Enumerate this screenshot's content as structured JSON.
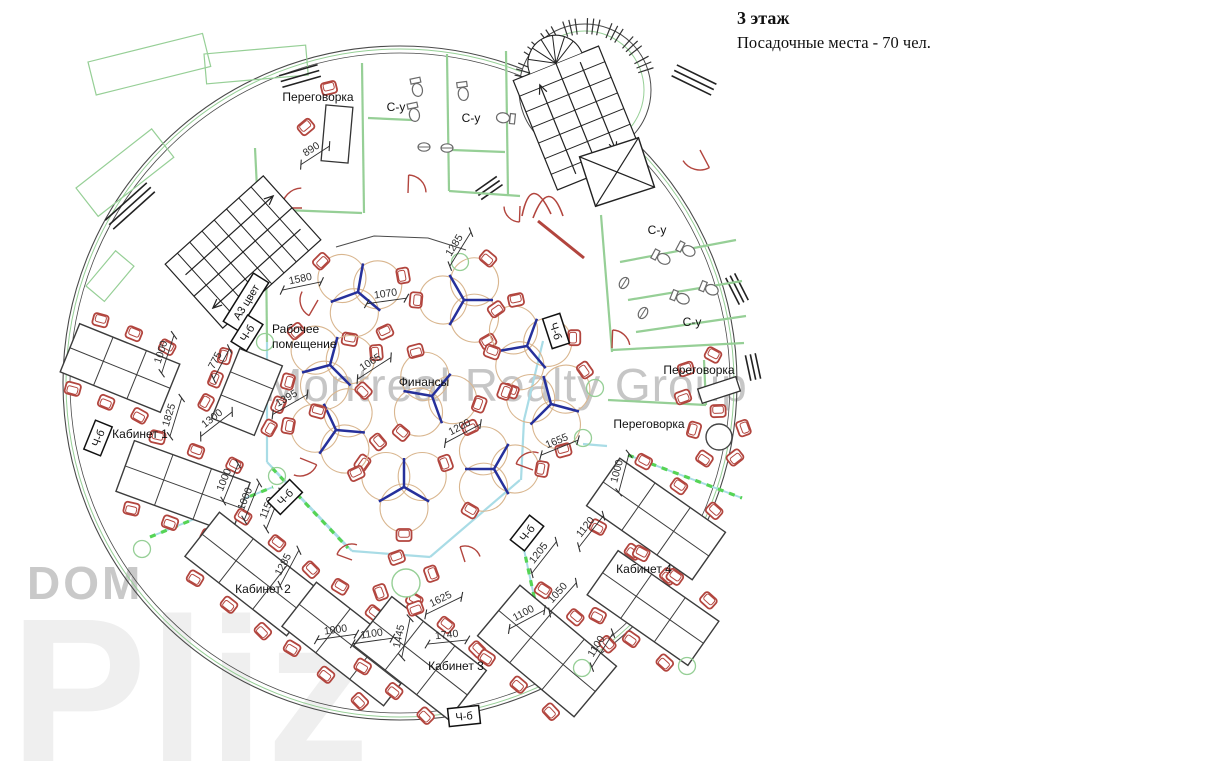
{
  "title": {
    "line1": "3 этаж",
    "line2": "Посадочные места - 70  чел."
  },
  "watermarks": {
    "main": "Montreal Realty Group",
    "brand_top": "DOM",
    "brand_bottom": "Pliz"
  },
  "colors": {
    "wall_green": "#96cf96",
    "chair_red": "#b2453e",
    "desk_line": "#3c3c3c",
    "blue_desk": "#26309b",
    "tan": "#d9b68f",
    "cyan": "#a9dce6",
    "dash_green": "#55d455",
    "dim": "#2e2e2e",
    "outer": "#4a4a4a",
    "fixture": "#6a6a6a",
    "label": "#111111"
  },
  "plan": {
    "rooms": [
      {
        "t": "Переговорка",
        "x": 318,
        "y": 101
      },
      {
        "t": "С-у",
        "x": 396,
        "y": 111
      },
      {
        "t": "С-у",
        "x": 471,
        "y": 122
      },
      {
        "t": "С-у",
        "x": 657,
        "y": 234
      },
      {
        "t": "С-у",
        "x": 692,
        "y": 326
      },
      {
        "t": "Переговорка",
        "x": 699,
        "y": 374
      },
      {
        "t": "Переговорка",
        "x": 649,
        "y": 428
      },
      {
        "t": "Финансы",
        "x": 424,
        "y": 386
      },
      {
        "t": "Кабинет 1",
        "x": 140,
        "y": 438
      },
      {
        "t": "Кабинет 2",
        "x": 263,
        "y": 593
      },
      {
        "t": "Кабинет 3",
        "x": 456,
        "y": 670
      },
      {
        "t": "Кабинет 4",
        "x": 644,
        "y": 573
      }
    ],
    "work_room": {
      "lines": [
        "Рабочее",
        "помещение"
      ],
      "x": 272,
      "y": 333,
      "line_gap": 15
    },
    "print_tags": [
      {
        "t": "А3 цвет",
        "x": 246,
        "y": 302,
        "r": -58
      },
      {
        "t": "Ч-б",
        "x": 247,
        "y": 333,
        "r": -58
      },
      {
        "t": "Ч-б",
        "x": 556,
        "y": 331,
        "r": 72
      },
      {
        "t": "Ч-б",
        "x": 98,
        "y": 438,
        "r": -68
      },
      {
        "t": "Ч-б",
        "x": 285,
        "y": 497,
        "r": -45
      },
      {
        "t": "Ч-б",
        "x": 527,
        "y": 533,
        "r": -52
      },
      {
        "t": "Ч-б",
        "x": 464,
        "y": 716,
        "r": -6
      }
    ],
    "dimensions": [
      {
        "t": "890",
        "x": 313,
        "y": 152,
        "r": -33
      },
      {
        "t": "1285",
        "x": 457,
        "y": 247,
        "r": -58
      },
      {
        "t": "1580",
        "x": 301,
        "y": 282,
        "r": -12
      },
      {
        "t": "1070",
        "x": 386,
        "y": 297,
        "r": -8
      },
      {
        "t": "1065",
        "x": 372,
        "y": 365,
        "r": -33
      },
      {
        "t": "1395",
        "x": 288,
        "y": 401,
        "r": -30
      },
      {
        "t": "775",
        "x": 218,
        "y": 362,
        "r": -62
      },
      {
        "t": "1000",
        "x": 164,
        "y": 353,
        "r": -72
      },
      {
        "t": "1825",
        "x": 172,
        "y": 416,
        "r": -73
      },
      {
        "t": "1300",
        "x": 214,
        "y": 421,
        "r": -38
      },
      {
        "t": "1200",
        "x": 461,
        "y": 430,
        "r": -28
      },
      {
        "t": "1655",
        "x": 558,
        "y": 444,
        "r": -22
      },
      {
        "t": "1000",
        "x": 620,
        "y": 472,
        "r": -75
      },
      {
        "t": "1120",
        "x": 588,
        "y": 529,
        "r": -52
      },
      {
        "t": "1205",
        "x": 541,
        "y": 555,
        "r": -52
      },
      {
        "t": "1000",
        "x": 227,
        "y": 481,
        "r": -68
      },
      {
        "t": "1000",
        "x": 248,
        "y": 500,
        "r": -68
      },
      {
        "t": "1150",
        "x": 270,
        "y": 509,
        "r": -68
      },
      {
        "t": "1285",
        "x": 286,
        "y": 566,
        "r": -62
      },
      {
        "t": "1000",
        "x": 336,
        "y": 633,
        "r": -8
      },
      {
        "t": "1100",
        "x": 372,
        "y": 637,
        "r": -8
      },
      {
        "t": "1445",
        "x": 402,
        "y": 637,
        "r": -78
      },
      {
        "t": "1625",
        "x": 442,
        "y": 602,
        "r": -26
      },
      {
        "t": "1740",
        "x": 447,
        "y": 638,
        "r": -6
      },
      {
        "t": "1100",
        "x": 525,
        "y": 616,
        "r": -28
      },
      {
        "t": "1050",
        "x": 560,
        "y": 595,
        "r": -48
      },
      {
        "t": "1100",
        "x": 599,
        "y": 648,
        "r": -58
      }
    ],
    "structure": {
      "center": [
        400,
        383
      ],
      "radii": [
        337,
        334,
        330
      ],
      "tower": {
        "cx": 585,
        "cy": 90,
        "r": 66,
        "r2": 59,
        "tick_angles": [
          192,
          212,
          232,
          252,
          272,
          292,
          312,
          332
        ]
      },
      "balconies": [
        [
          88,
          62,
          118,
          34,
          -14
        ],
        [
          204,
          54,
          102,
          30,
          -5
        ],
        [
          76,
          188,
          96,
          36,
          -38
        ],
        [
          86,
          286,
          46,
          24,
          -50
        ]
      ],
      "bars": [
        [
          300,
          76,
          -16,
          3,
          40,
          6
        ],
        [
          694,
          80,
          26,
          3,
          44,
          6
        ],
        [
          130,
          206,
          -42,
          3,
          56,
          6
        ],
        [
          737,
          289,
          63,
          3,
          30,
          5
        ],
        [
          753,
          367,
          78,
          3,
          26,
          5
        ],
        [
          489,
          188,
          -35,
          3,
          26,
          5
        ]
      ],
      "walls": [
        [
          255,
          148,
          258,
          209
        ],
        [
          258,
          209,
          362,
          213
        ],
        [
          362,
          63,
          364,
          213
        ],
        [
          447,
          54,
          449,
          191
        ],
        [
          449,
          191,
          520,
          196
        ],
        [
          506,
          51,
          508,
          196
        ],
        [
          368,
          118,
          412,
          120
        ],
        [
          452,
          150,
          505,
          152
        ],
        [
          601,
          215,
          612,
          352
        ],
        [
          612,
          350,
          744,
          343
        ],
        [
          620,
          262,
          736,
          240
        ],
        [
          628,
          300,
          742,
          281
        ],
        [
          636,
          332,
          746,
          316
        ],
        [
          608,
          400,
          706,
          405
        ],
        [
          704,
          360,
          706,
          405
        ],
        [
          266,
          248,
          267,
          342
        ]
      ],
      "core_arc": "M336,247 L374,236 L428,238 L466,250",
      "cyan": [
        [
          267,
          342,
          267,
          462
        ],
        [
          267,
          462,
          352,
          551
        ],
        [
          352,
          551,
          430,
          557
        ],
        [
          430,
          557,
          520,
          480
        ],
        [
          521,
          480,
          524,
          420
        ],
        [
          524,
          420,
          543,
          341
        ],
        [
          583,
          444,
          607,
          446
        ]
      ],
      "dashes": [
        [
          150,
          537,
          273,
          487
        ],
        [
          272,
          468,
          348,
          548
        ],
        [
          523,
          545,
          546,
          652
        ],
        [
          628,
          455,
          742,
          498
        ]
      ],
      "doors": [
        [
          302,
          208,
          20,
          180,
          268
        ],
        [
          408,
          193,
          18,
          272,
          358
        ],
        [
          520,
          206,
          16,
          92,
          178
        ],
        [
          700,
          150,
          20,
          62,
          148
        ],
        [
          612,
          348,
          18,
          272,
          350
        ],
        [
          318,
          300,
          18,
          120,
          208
        ],
        [
          300,
          458,
          18,
          22,
          110
        ],
        [
          533,
          470,
          18,
          200,
          288
        ],
        [
          465,
          562,
          16,
          252,
          340
        ],
        [
          352,
          560,
          16,
          200,
          288
        ]
      ],
      "red_lines": [
        [
          538,
          221,
          584,
          258
        ]
      ],
      "tulip": [
        "M522,216 Q531,172 551,214",
        "M533,218 Q549,176 563,216"
      ],
      "stairs": [
        {
          "cx": 243,
          "cy": 252,
          "rot": -42,
          "w": 132,
          "h": 86,
          "steps": 8,
          "axis": "w",
          "fan": false
        },
        {
          "cx": 578,
          "cy": 118,
          "rot": -22,
          "w": 92,
          "h": 118,
          "steps": 7,
          "axis": "h",
          "fan": true
        }
      ],
      "elevator": {
        "cx": 617,
        "cy": 172,
        "rot": -18,
        "w": 62,
        "h": 52
      }
    },
    "furniture": {
      "desk_banks": [
        {
          "cx": 120,
          "cy": 368,
          "rot": 22,
          "cols": 3,
          "rows": 2,
          "cw": 36,
          "ch": 26
        },
        {
          "cx": 247,
          "cy": 392,
          "rot": 22,
          "cols": 1,
          "rows": 3,
          "cw": 46,
          "ch": 25
        },
        {
          "cx": 183,
          "cy": 487,
          "rot": 20,
          "cols": 3,
          "rows": 2,
          "cw": 41,
          "ch": 27
        },
        {
          "cx": 253,
          "cy": 574,
          "rot": 38,
          "cols": 3,
          "rows": 2,
          "cw": 43,
          "ch": 28
        },
        {
          "cx": 350,
          "cy": 644,
          "rot": 38,
          "cols": 3,
          "rows": 2,
          "cw": 43,
          "ch": 28
        },
        {
          "cx": 420,
          "cy": 658,
          "rot": -52,
          "cols": 2,
          "rows": 3,
          "cw": 31,
          "ch": 40
        },
        {
          "cx": 547,
          "cy": 651,
          "rot": -50,
          "cols": 2,
          "rows": 3,
          "cw": 33,
          "ch": 42
        },
        {
          "cx": 656,
          "cy": 519,
          "rot": 35,
          "cols": 3,
          "rows": 2,
          "cw": 43,
          "ch": 29
        },
        {
          "cx": 653,
          "cy": 608,
          "rot": 35,
          "cols": 3,
          "rows": 2,
          "cw": 41,
          "ch": 27
        }
      ],
      "y_units": [
        [
          358,
          292,
          10
        ],
        [
          464,
          300,
          -30
        ],
        [
          527,
          346,
          20
        ],
        [
          551,
          404,
          -15
        ],
        [
          494,
          469,
          30
        ],
        [
          404,
          487,
          0
        ],
        [
          336,
          430,
          -25
        ],
        [
          330,
          365,
          15
        ],
        [
          432,
          396,
          40
        ]
      ],
      "loose_chairs": [
        [
          385,
          332,
          -25
        ],
        [
          492,
          352,
          20
        ],
        [
          378,
          442,
          50
        ],
        [
          516,
          300,
          -12
        ]
      ],
      "meeting_chairs": [
        [
          329,
          88,
          -14
        ],
        [
          306,
          127,
          -40
        ],
        [
          686,
          369,
          -18
        ],
        [
          683,
          397,
          160
        ],
        [
          713,
          355,
          28
        ]
      ],
      "rect_tables": [
        {
          "cx": 337,
          "cy": 134,
          "w": 27,
          "h": 56,
          "rot": 5
        },
        {
          "cx": 719,
          "cy": 390,
          "w": 40,
          "h": 15,
          "rot": -18
        }
      ],
      "round_tables": [
        {
          "x": 719,
          "y": 437,
          "r": 13,
          "chairs": 5,
          "green": false
        },
        {
          "x": 406,
          "y": 583,
          "r": 14,
          "chairs": 4,
          "green": true
        }
      ],
      "columns": [
        [
          265,
          342
        ],
        [
          460,
          262
        ],
        [
          583,
          438
        ],
        [
          277,
          476
        ],
        [
          142,
          549
        ],
        [
          687,
          666
        ],
        [
          582,
          668
        ],
        [
          595,
          388
        ]
      ],
      "wc": [
        [
          417,
          88,
          -12
        ],
        [
          463,
          92,
          -8
        ],
        [
          414,
          113,
          -12
        ],
        [
          505,
          118,
          96
        ],
        [
          662,
          258,
          -62
        ],
        [
          687,
          250,
          -62
        ],
        [
          681,
          298,
          -68
        ],
        [
          710,
          289,
          -68
        ]
      ],
      "sinks": [
        [
          424,
          147,
          0
        ],
        [
          447,
          148,
          0
        ],
        [
          624,
          283,
          -58
        ],
        [
          643,
          313,
          -58
        ]
      ]
    }
  }
}
